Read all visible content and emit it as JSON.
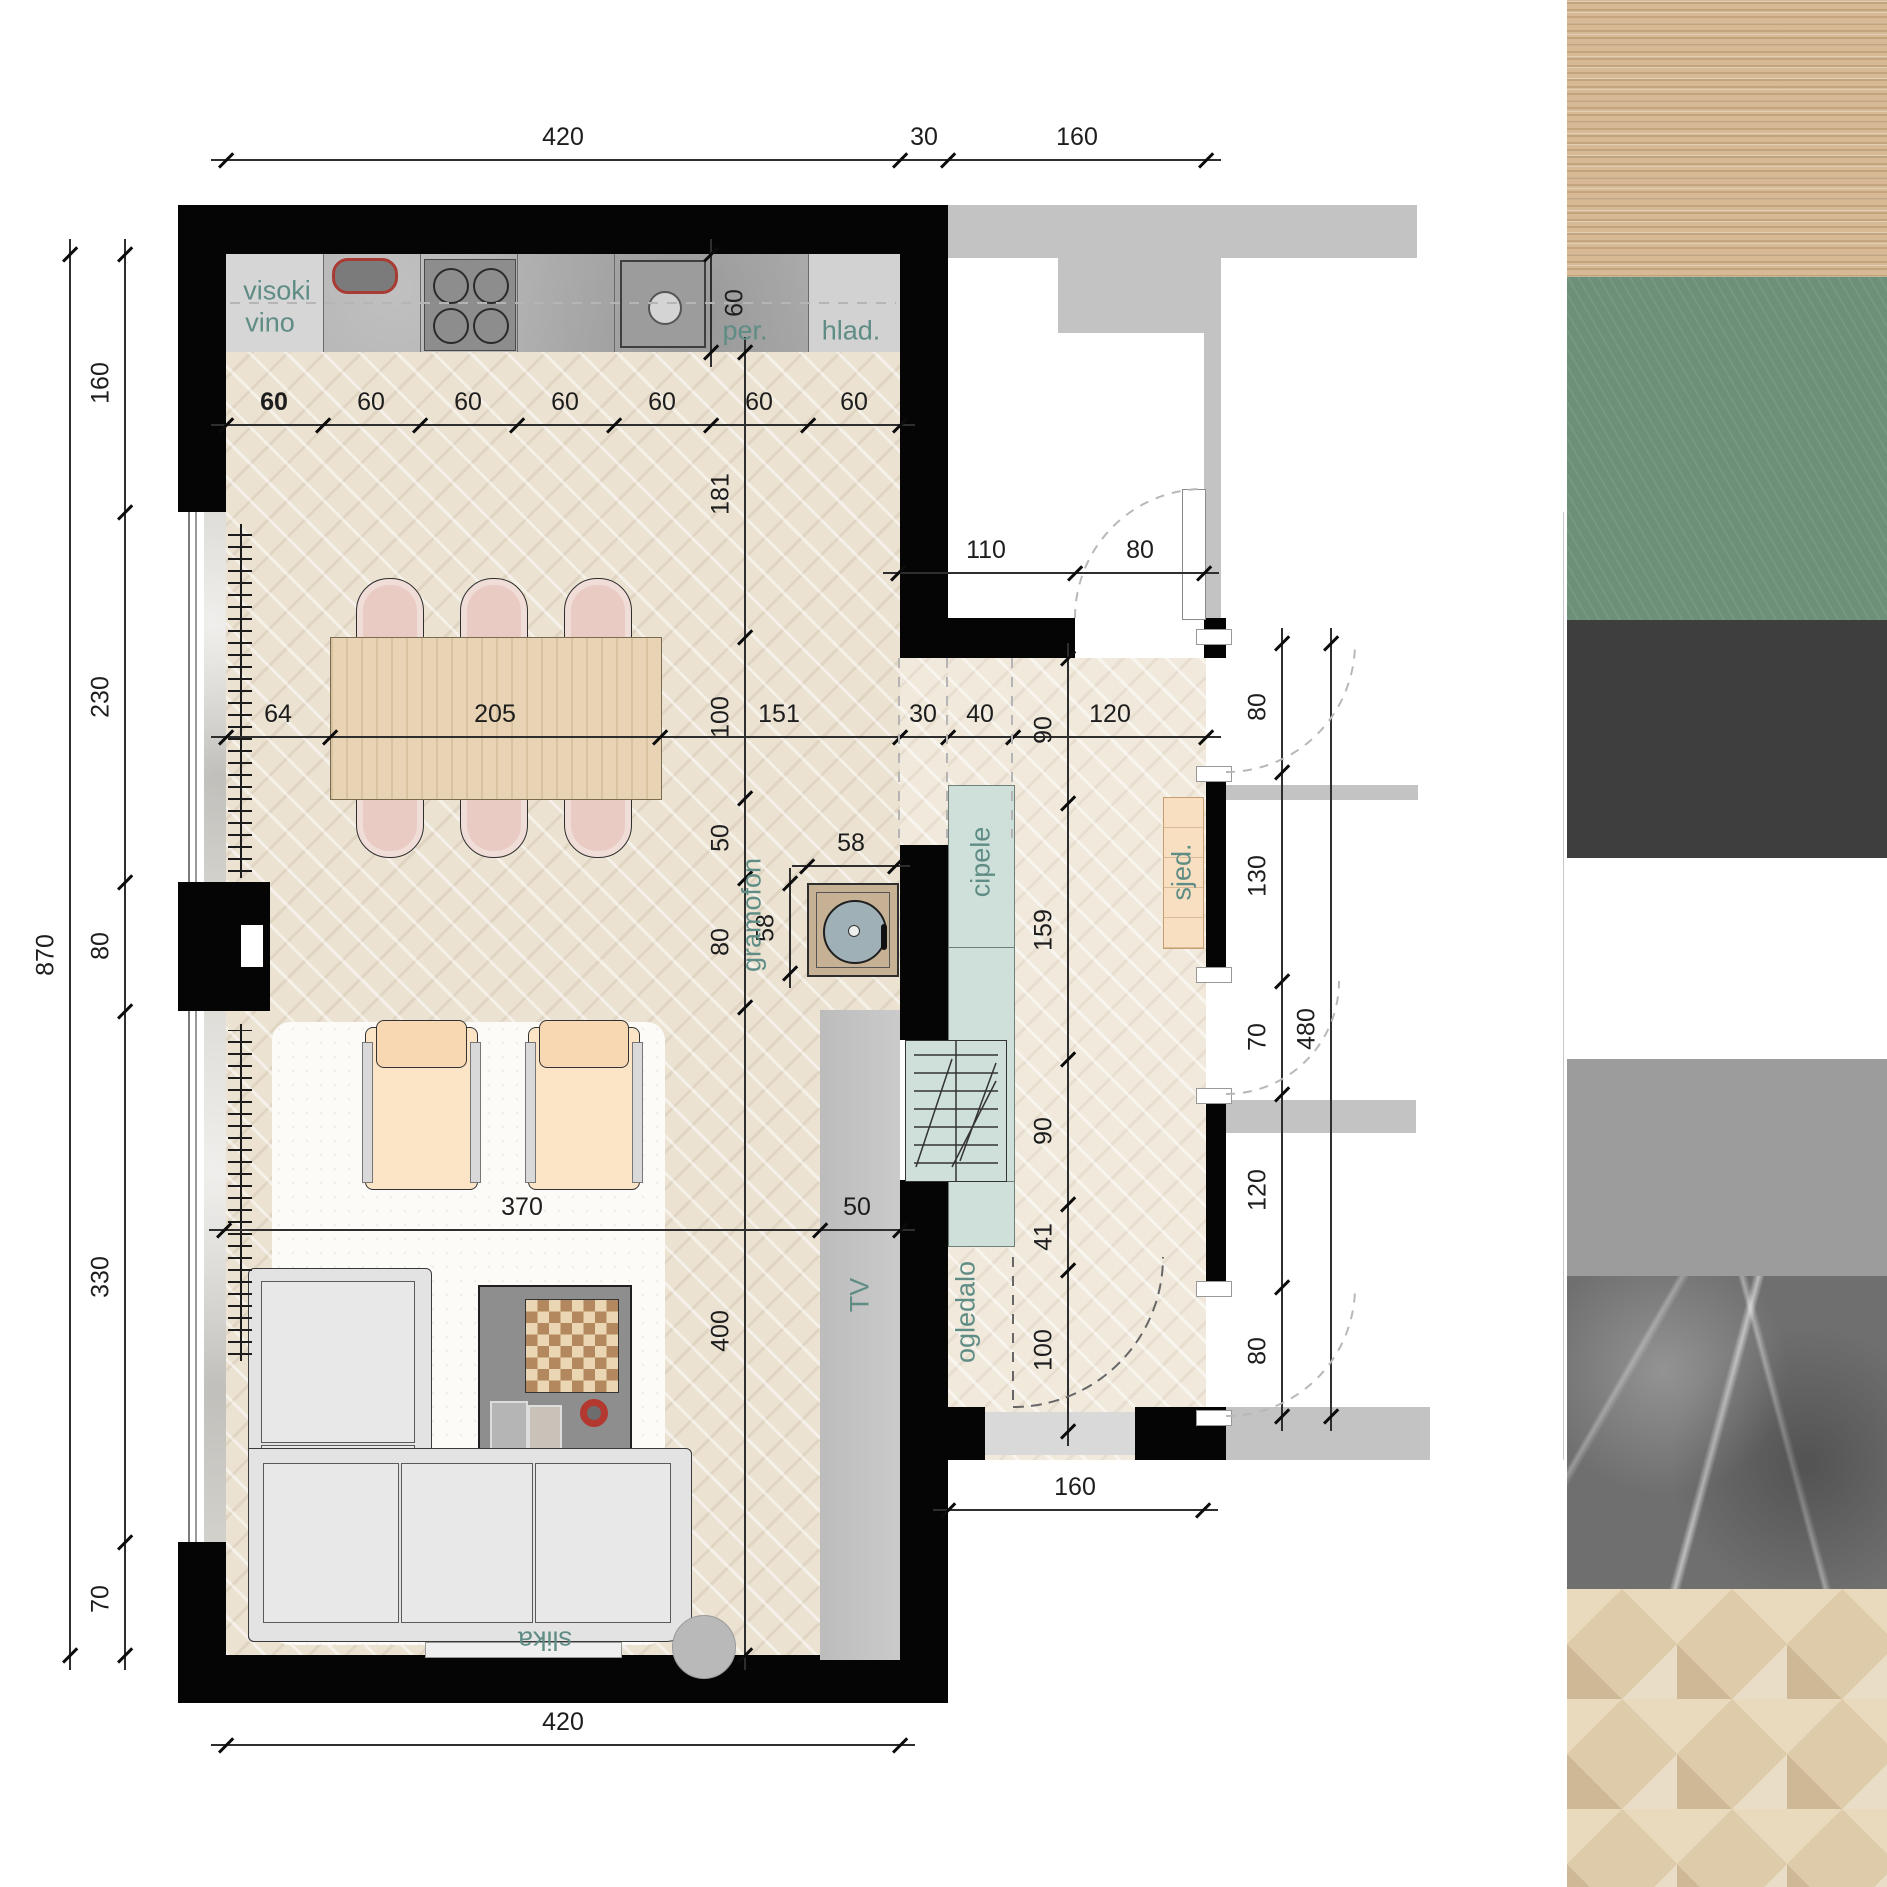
{
  "drawing": {
    "type": "interior floor plan with material palette",
    "accent_green_label_color": "#5f8d86",
    "dim_text_color": "#1d1d1d",
    "wall_color": "#050505",
    "neighbor_wall_color": "#c3c3c3"
  },
  "palette": {
    "x": 1567,
    "width": 320,
    "swatches": [
      {
        "name": "light-oak-wood",
        "color": "#d7ba95",
        "top": 0,
        "height": 277
      },
      {
        "name": "sage-green",
        "color": "#6d9078",
        "top": 277,
        "height": 343
      },
      {
        "name": "charcoal",
        "color": "#3e3e3e",
        "top": 620,
        "height": 238
      },
      {
        "name": "white",
        "color": "#ffffff",
        "top": 858,
        "height": 201
      },
      {
        "name": "mid-gray",
        "color": "#9c9c9c",
        "top": 1059,
        "height": 217
      },
      {
        "name": "gray-marble",
        "color": "#6f6f6f",
        "top": 1276,
        "height": 313
      },
      {
        "name": "herringbone-oak",
        "color": "#decbaa",
        "top": 1589,
        "height": 298
      }
    ]
  },
  "plan": {
    "room_labels": [
      {
        "t": "visoki",
        "x": 277,
        "y": 291,
        "r": 0
      },
      {
        "t": "vino",
        "x": 270,
        "y": 323,
        "r": 0
      },
      {
        "t": "per.",
        "x": 745,
        "y": 331,
        "r": 0
      },
      {
        "t": "hlad.",
        "x": 851,
        "y": 331,
        "r": 0
      },
      {
        "t": "gramofon",
        "x": 752,
        "y": 915,
        "r": -90
      },
      {
        "t": "cipele",
        "x": 981,
        "y": 862,
        "r": -90
      },
      {
        "t": "sjed.",
        "x": 1182,
        "y": 872,
        "r": -90
      },
      {
        "t": "ogledalo",
        "x": 966,
        "y": 1312,
        "r": -90
      },
      {
        "t": "TV",
        "x": 860,
        "y": 1295,
        "r": -90
      },
      {
        "t": "slika",
        "x": 545,
        "y": 1640,
        "r": 180
      }
    ],
    "hdims": [
      {
        "y": 160,
        "ticks": [
          226,
          900,
          948,
          1206
        ],
        "labels": [
          {
            "t": "420",
            "x": 563
          },
          {
            "t": "30",
            "x": 924
          },
          {
            "t": "160",
            "x": 1077
          }
        ]
      },
      {
        "y": 425,
        "ticks": [
          226,
          323,
          420,
          517,
          614,
          711,
          808,
          900
        ],
        "labels": [
          {
            "t": "60",
            "x": 274,
            "b": 1
          },
          {
            "t": "60",
            "x": 371
          },
          {
            "t": "60",
            "x": 468
          },
          {
            "t": "60",
            "x": 565
          },
          {
            "t": "60",
            "x": 662
          },
          {
            "t": "60",
            "x": 759
          },
          {
            "t": "60",
            "x": 854
          }
        ]
      },
      {
        "y": 737,
        "ticks": [
          226,
          330,
          660,
          900,
          948,
          1013,
          1206
        ],
        "labels": [
          {
            "t": "64",
            "x": 278
          },
          {
            "t": "205",
            "x": 495
          },
          {
            "t": "151",
            "x": 779
          },
          {
            "t": "30",
            "x": 923
          },
          {
            "t": "40",
            "x": 980
          },
          {
            "t": "120",
            "x": 1110
          }
        ]
      },
      {
        "y": 573,
        "ticks": [
          898,
          1075,
          1204
        ],
        "labels": [
          {
            "t": "110",
            "x": 986
          },
          {
            "t": "80",
            "x": 1140
          }
        ]
      },
      {
        "y": 866,
        "ticks": [
          807,
          895
        ],
        "labels": [
          {
            "t": "58",
            "x": 851
          }
        ]
      },
      {
        "y": 1230,
        "ticks": [
          224,
          820,
          900
        ],
        "labels": [
          {
            "t": "370",
            "x": 522
          },
          {
            "t": "50",
            "x": 857
          }
        ]
      },
      {
        "y": 1510,
        "ticks": [
          948,
          1203
        ],
        "labels": [
          {
            "t": "160",
            "x": 1075
          }
        ]
      },
      {
        "y": 1745,
        "ticks": [
          226,
          900
        ],
        "labels": [
          {
            "t": "420",
            "x": 563
          }
        ]
      }
    ],
    "vdims": [
      {
        "x": 70,
        "ticks": [
          254,
          1655
        ],
        "labels": [
          {
            "t": "870",
            "y": 955
          }
        ]
      },
      {
        "x": 125,
        "ticks": [
          254,
          512,
          882,
          1011,
          1542,
          1655
        ],
        "labels": [
          {
            "t": "160",
            "y": 383
          },
          {
            "t": "230",
            "y": 697
          },
          {
            "t": "80",
            "y": 946
          },
          {
            "t": "330",
            "y": 1277
          },
          {
            "t": "70",
            "y": 1599
          }
        ]
      },
      {
        "x": 745,
        "ticks": [
          352,
          637,
          798,
          878,
          1007,
          1655
        ],
        "labels": [
          {
            "t": "181",
            "y": 494
          },
          {
            "t": "100",
            "y": 717
          },
          {
            "t": "50",
            "y": 838
          },
          {
            "t": "80",
            "y": 942
          },
          {
            "t": "400",
            "y": 1331
          }
        ]
      },
      {
        "x": 711,
        "ticks": [
          254,
          352
        ],
        "labels": [
          {
            "t": "60",
            "y": 303
          }
        ],
        "lo": 24
      },
      {
        "x": 790,
        "ticks": [
          883,
          973
        ],
        "labels": [
          {
            "t": "58",
            "y": 928
          }
        ]
      },
      {
        "x": 1068,
        "ticks": [
          658,
          803,
          1059,
          1204,
          1270,
          1431
        ],
        "labels": [
          {
            "t": "90",
            "y": 730
          },
          {
            "t": "159",
            "y": 930
          },
          {
            "t": "90",
            "y": 1131
          },
          {
            "t": "41",
            "y": 1237
          },
          {
            "t": "100",
            "y": 1350
          }
        ]
      },
      {
        "x": 1282,
        "ticks": [
          643,
          772,
          981,
          1094,
          1287,
          1416
        ],
        "labels": [
          {
            "t": "80",
            "y": 707
          },
          {
            "t": "130",
            "y": 876
          },
          {
            "t": "70",
            "y": 1037
          },
          {
            "t": "120",
            "y": 1190
          },
          {
            "t": "80",
            "y": 1351
          }
        ]
      },
      {
        "x": 1331,
        "ticks": [
          643,
          1416
        ],
        "labels": [
          {
            "t": "480",
            "y": 1029
          }
        ]
      }
    ],
    "arcs": [
      {
        "name": "door-arc-top-room",
        "d": "M 1075 618 A 129 129 0 0 1 1204 489",
        "dark": 0
      },
      {
        "name": "door-arc-right-80a",
        "d": "M 1226 772 A 129 129 0 0 0 1355 643",
        "dark": 0
      },
      {
        "name": "door-arc-right-70",
        "d": "M 1226 1094 A 113 113 0 0 0 1339 981",
        "dark": 0
      },
      {
        "name": "door-arc-right-80b",
        "d": "M 1226 1416 A 129 129 0 0 0 1355 1287",
        "dark": 0
      },
      {
        "name": "entry-door-arc",
        "d": "M 1013 1407 A 150 150 0 0 0 1163 1257",
        "dark": 1
      }
    ],
    "dashes": [
      {
        "name": "counter-centerline",
        "x1": 230,
        "y1": 303,
        "x2": 896,
        "y2": 303,
        "dark": 0
      },
      {
        "name": "projection-1",
        "x1": 899,
        "y1": 658,
        "x2": 899,
        "y2": 838,
        "dark": 0
      },
      {
        "name": "projection-2",
        "x1": 947,
        "y1": 658,
        "x2": 947,
        "y2": 838,
        "dark": 0
      },
      {
        "name": "projection-3",
        "x1": 1012,
        "y1": 658,
        "x2": 1012,
        "y2": 838,
        "dark": 0
      },
      {
        "name": "entry-door-leaf",
        "x1": 1013,
        "y1": 1257,
        "x2": 1013,
        "y2": 1407,
        "dark": 1
      }
    ],
    "jambs": [
      {
        "x": 1196,
        "y": 629
      },
      {
        "x": 1196,
        "y": 766
      },
      {
        "x": 1196,
        "y": 967
      },
      {
        "x": 1196,
        "y": 1088
      },
      {
        "x": 1196,
        "y": 1281
      },
      {
        "x": 1196,
        "y": 1410
      }
    ]
  }
}
